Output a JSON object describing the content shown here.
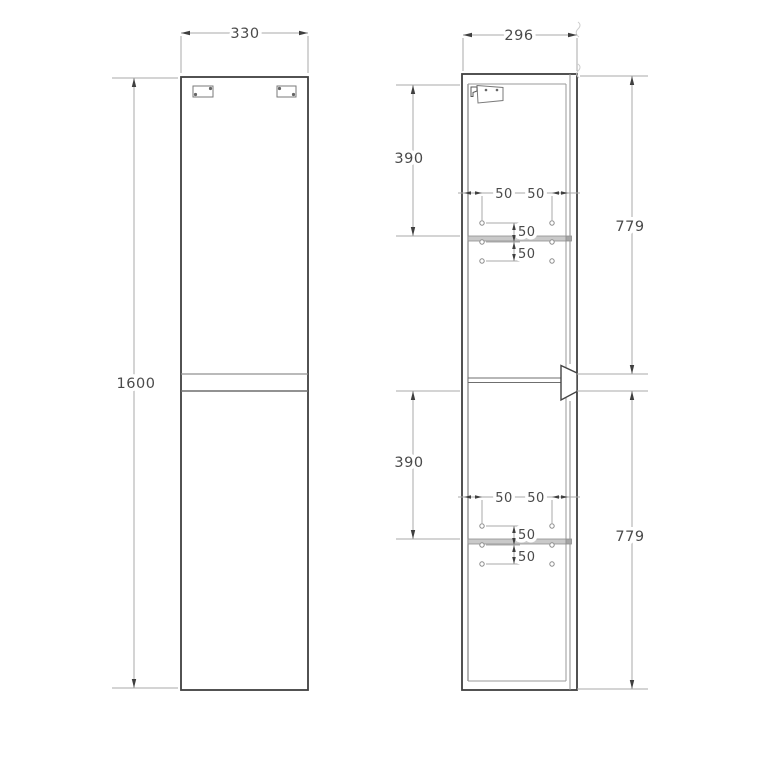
{
  "drawing_type": "cabinet technical drawing",
  "front_view": {
    "width_mm": "330",
    "height_mm": "1600"
  },
  "side_view": {
    "depth_mm": "296",
    "upper": {
      "shelf_drop_mm": "390",
      "section_height_mm": "779",
      "hole_edge_offsets_mm": [
        "50",
        "50"
      ],
      "hole_pitch_mm": [
        "50",
        "50"
      ]
    },
    "lower": {
      "shelf_drop_mm": "390",
      "section_height_mm": "779",
      "hole_edge_offsets_mm": [
        "50",
        "50"
      ],
      "hole_pitch_mm": [
        "50",
        "50"
      ]
    }
  }
}
